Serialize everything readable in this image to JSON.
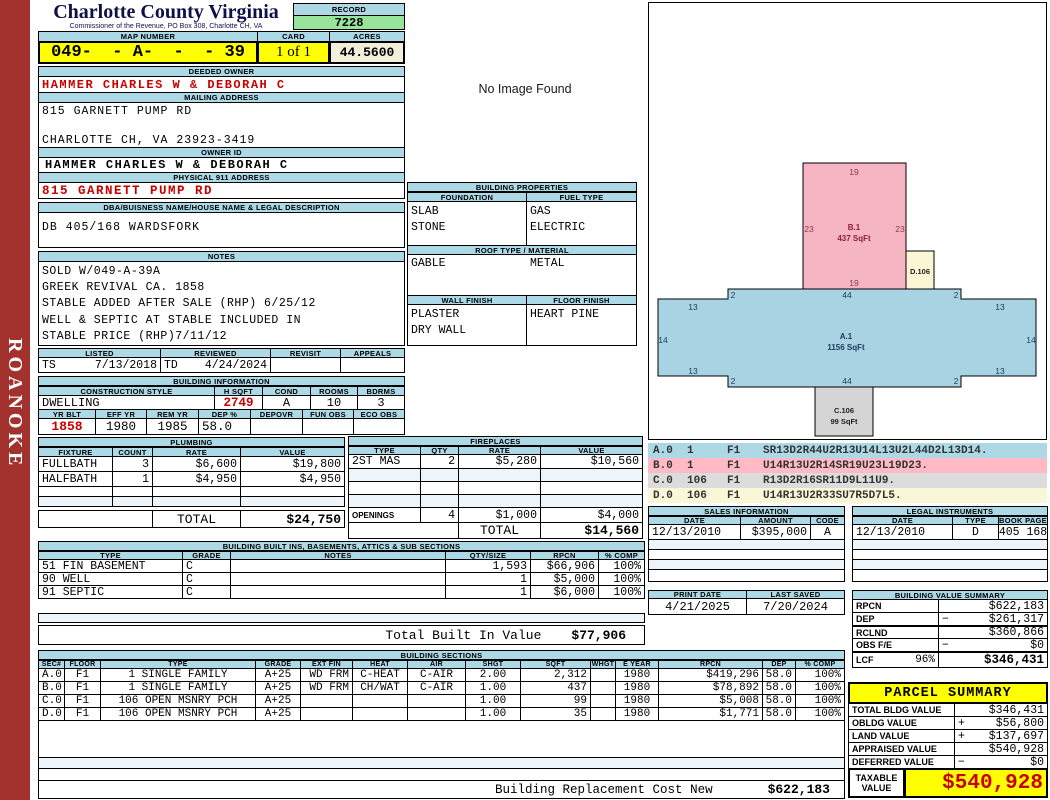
{
  "colors": {
    "header_blue": "#ADD8E6",
    "highlight_yellow": "#FFFF00",
    "record_green": "#98E49A",
    "acres_beige": "#F1EEDA",
    "alert_red": "#C80000",
    "sidebar_red": "#A3312D",
    "sketch_pink": "#F5B5C2",
    "sketch_blue": "#A8D3E3",
    "sketch_gray": "#D5D5D5",
    "sketch_cream": "#FBF7D5"
  },
  "sidebar": {
    "banner": "ROANOKE"
  },
  "header": {
    "county": "Charlotte County Virginia",
    "sub": "Commissioner of the Revenue, PO Box 308, Charlotte CH, VA",
    "record_label": "RECORD",
    "record": "7228",
    "map_label": "MAP NUMBER",
    "map": "049-  - A-  -  - 39",
    "card_label": "CARD",
    "card": "1 of 1",
    "acres_label": "ACRES",
    "acres": "44.5600"
  },
  "owner": {
    "deeded_label": "DEEDED OWNER",
    "deeded": "HAMMER CHARLES W & DEBORAH C",
    "mailing_label": "MAILING ADDRESS",
    "mailing1": "815 GARNETT PUMP RD",
    "mailing2": "CHARLOTTE CH, VA 23923-3419",
    "owner_id_label": "OWNER ID",
    "owner_id": "HAMMER CHARLES W & DEBORAH C",
    "physical_label": "PHYSICAL 911 ADDRESS",
    "physical": "815 GARNETT PUMP RD",
    "dba_label": "DBA/BUISNESS NAME/HOUSE NAME & LEGAL DESCRIPTION",
    "legal": "DB 405/168 WARDSFORK"
  },
  "notes": {
    "label": "NOTES",
    "lines": [
      "SOLD W/049-A-39A",
      "GREEK REVIVAL CA. 1858",
      "STABLE ADDED AFTER SALE (RHP) 6/25/12",
      "WELL & SEPTIC AT STABLE INCLUDED IN",
      "STABLE PRICE (RHP)7/11/12"
    ]
  },
  "visits": {
    "listed_label": "LISTED",
    "reviewed_label": "REVIEWED",
    "revisit_label": "REVISIT",
    "appeals_label": "APPEALS",
    "listed_by": "TS",
    "listed_date": "7/13/2018",
    "reviewed_by": "TD",
    "reviewed_date": "4/24/2024"
  },
  "building_info": {
    "title": "BUILDING INFORMATION",
    "style_label": "CONSTRUCTION STYLE",
    "hsqft_label": "H SQFT",
    "cond_label": "COND",
    "rooms_label": "ROOMS",
    "bdrms_label": "BDRMS",
    "style": "DWELLING",
    "hsqft": "2749",
    "cond": "A",
    "rooms": "10",
    "bdrms": "3",
    "yrblt_label": "YR BLT",
    "effyr_label": "EFF YR",
    "remyr_label": "REM YR",
    "dep_label": "DEP %",
    "depovr_label": "DEPOVR",
    "funobs_label": "FUN OBS",
    "ecoobs_label": "ECO OBS",
    "yrblt": "1858",
    "effyr": "1980",
    "remyr": "1985",
    "dep": "58.0"
  },
  "plumbing": {
    "title": "PLUMBING",
    "fixture_label": "FIXTURE",
    "count_label": "COUNT",
    "rate_label": "RATE",
    "value_label": "VALUE",
    "rows": [
      {
        "fixture": "FULLBATH",
        "count": "3",
        "rate": "$6,600",
        "value": "$19,800"
      },
      {
        "fixture": "HALFBATH",
        "count": "1",
        "rate": "$4,950",
        "value": "$4,950"
      }
    ],
    "total_label": "TOTAL",
    "total": "$24,750"
  },
  "fireplaces": {
    "title": "FIREPLACES",
    "type_label": "TYPE",
    "qty_label": "QTY",
    "rate_label": "RATE",
    "value_label": "VALUE",
    "rows": [
      {
        "type": "2ST MAS",
        "qty": "2",
        "rate": "$5,280",
        "value": "$10,560"
      }
    ],
    "openings_label": "OPENINGS",
    "openings_qty": "4",
    "openings_rate": "$1,000",
    "openings_value": "$4,000",
    "total_label": "TOTAL",
    "total": "$14,560"
  },
  "built_ins": {
    "title": "BUILDING BUILT INS, BASEMENTS, ATTICS & SUB SECTIONS",
    "type_label": "TYPE",
    "grade_label": "GRADE",
    "notes_label": "NOTES",
    "qty_label": "QTY/SIZE",
    "rpcn_label": "RPCN",
    "comp_label": "% COMP",
    "rows": [
      {
        "type": "51 FIN BASEMENT",
        "grade": "C",
        "notes": "",
        "qty": "1,593",
        "rpcn": "$66,906",
        "comp": "100%"
      },
      {
        "type": "90 WELL",
        "grade": "C",
        "notes": "",
        "qty": "1",
        "rpcn": "$5,000",
        "comp": "100%"
      },
      {
        "type": "91 SEPTIC",
        "grade": "C",
        "notes": "",
        "qty": "1",
        "rpcn": "$6,000",
        "comp": "100%"
      }
    ],
    "total_label": "Total Built In Value",
    "total": "$77,906"
  },
  "sections": {
    "title": "BUILDING SECTIONS",
    "headers": {
      "sec": "SEC#",
      "floor": "FLOOR",
      "type": "TYPE",
      "grade": "GRADE",
      "extfin": "EXT FIN",
      "heat": "HEAT",
      "air": "AIR",
      "shgt": "SHGT",
      "sqft": "SQFT",
      "whgt": "WHGT",
      "eyear": "E YEAR",
      "rpcn": "RPCN",
      "dep": "DEP",
      "comp": "% COMP"
    },
    "rows": [
      {
        "sec": "A.0",
        "floor": "F1",
        "type": "1 SINGLE FAMILY",
        "grade": "A+25",
        "extfin": "WD FRM",
        "heat": "C-HEAT",
        "air": "C-AIR",
        "shgt": "2.00",
        "sqft": "2,312",
        "whgt": "",
        "eyear": "1980",
        "rpcn": "$419,296",
        "dep": "58.0",
        "comp": "100%"
      },
      {
        "sec": "B.0",
        "floor": "F1",
        "type": "1 SINGLE FAMILY",
        "grade": "A+25",
        "extfin": "WD FRM",
        "heat": "CH/WAT",
        "air": "C-AIR",
        "shgt": "1.00",
        "sqft": "437",
        "whgt": "",
        "eyear": "1980",
        "rpcn": "$78,892",
        "dep": "58.0",
        "comp": "100%"
      },
      {
        "sec": "C.0",
        "floor": "F1",
        "type": "106 OPEN MSNRY PCH",
        "grade": "A+25",
        "extfin": "",
        "heat": "",
        "air": "",
        "shgt": "1.00",
        "sqft": "99",
        "whgt": "",
        "eyear": "1980",
        "rpcn": "$5,008",
        "dep": "58.0",
        "comp": "100%"
      },
      {
        "sec": "D.0",
        "floor": "F1",
        "type": "106 OPEN MSNRY PCH",
        "grade": "A+25",
        "extfin": "",
        "heat": "",
        "air": "",
        "shgt": "1.00",
        "sqft": "35",
        "whgt": "",
        "eyear": "1980",
        "rpcn": "$1,771",
        "dep": "58.0",
        "comp": "100%"
      }
    ]
  },
  "footer": {
    "label": "Building Replacement Cost New",
    "value": "$622,183"
  },
  "properties": {
    "title": "BUILDING PROPERTIES",
    "foundation_label": "FOUNDATION",
    "fuel_label": "FUEL TYPE",
    "foundation": [
      "SLAB",
      "STONE"
    ],
    "fuel": [
      "GAS",
      "ELECTRIC"
    ],
    "roof_label": "ROOF TYPE / MATERIAL",
    "roof_type": "GABLE",
    "roof_material": "METAL",
    "wall_label": "WALL FINISH",
    "floor_label": "FLOOR FINISH",
    "wall": [
      "PLASTER",
      "DRY WALL"
    ],
    "floor": [
      "HEART PINE"
    ]
  },
  "no_image_text": "No Image Found",
  "sketch": {
    "a_name": "A.1",
    "a_area": "1156 SqFt",
    "b_name": "B.1",
    "b_area": "437 SqFt",
    "c_name": "C.106",
    "c_area": "99 SqFt",
    "d_name": "D.106",
    "dims": {
      "b_top": "19",
      "b_left": "23",
      "b_right": "23",
      "b_bottom": "19",
      "a_tl": "2",
      "a_tm": "44",
      "a_tr": "2",
      "a_ul": "13",
      "a_ur": "13",
      "a_ml": "14",
      "a_mr": "14",
      "a_ll": "13",
      "a_lr": "13",
      "a_bl": "2",
      "a_bm": "44",
      "a_br": "2"
    }
  },
  "vectors": {
    "rows": [
      {
        "sec": "A.0",
        "code": "1",
        "floor": "F1",
        "path": "SR13D2R44U2R13U14L13U2L44D2L13D14."
      },
      {
        "sec": "B.0",
        "code": "1",
        "floor": "F1",
        "path": "U14R13U2R14SR19U23L19D23."
      },
      {
        "sec": "C.0",
        "code": "106",
        "floor": "F1",
        "path": "R13D2R16SR11D9L11U9."
      },
      {
        "sec": "D.0",
        "code": "106",
        "floor": "F1",
        "path": "U14R13U2R33SU7R5D7L5."
      }
    ]
  },
  "sales": {
    "title": "SALES INFORMATION",
    "date_label": "DATE",
    "amount_label": "AMOUNT",
    "code_label": "CODE",
    "rows": [
      {
        "date": "12/13/2010",
        "amount": "$395,000",
        "code": "A"
      }
    ]
  },
  "legal": {
    "title": "LEGAL INSTRUMENTS",
    "date_label": "DATE",
    "type_label": "TYPE",
    "book_label": "BOOK PAGE",
    "rows": [
      {
        "date": "12/13/2010",
        "type": "D",
        "book": "405 168"
      }
    ]
  },
  "dates": {
    "print_label": "PRINT DATE",
    "print": "4/21/2025",
    "saved_label": "LAST SAVED",
    "saved": "7/20/2024"
  },
  "value_summary": {
    "title": "BUILDING VALUE SUMMARY",
    "rows": [
      {
        "label": "RPCN",
        "sign": "",
        "value": "$622,183"
      },
      {
        "label": "DEP",
        "sign": "−",
        "value": "$261,317"
      },
      {
        "label": "RCLND",
        "sign": "",
        "value": "$360,866"
      },
      {
        "label": "OBS F/E",
        "sign": "−",
        "value": "$0"
      },
      {
        "label": "LCF",
        "pct": "96%",
        "sign": "",
        "value": "$346,431"
      }
    ]
  },
  "parcel": {
    "title": "PARCEL SUMMARY",
    "rows": [
      {
        "label": "TOTAL BLDG VALUE",
        "sign": "",
        "value": "$346,431"
      },
      {
        "label": "OBLDG VALUE",
        "sign": "+",
        "value": "$56,800"
      },
      {
        "label": "LAND VALUE",
        "sign": "+",
        "value": "$137,697"
      },
      {
        "label": "APPRAISED VALUE",
        "sign": "",
        "value": "$540,928"
      },
      {
        "label": "DEFERRED VALUE",
        "sign": "−",
        "value": "$0"
      }
    ],
    "taxable_label1": "TAXABLE",
    "taxable_label2": "VALUE",
    "taxable": "$540,928"
  }
}
